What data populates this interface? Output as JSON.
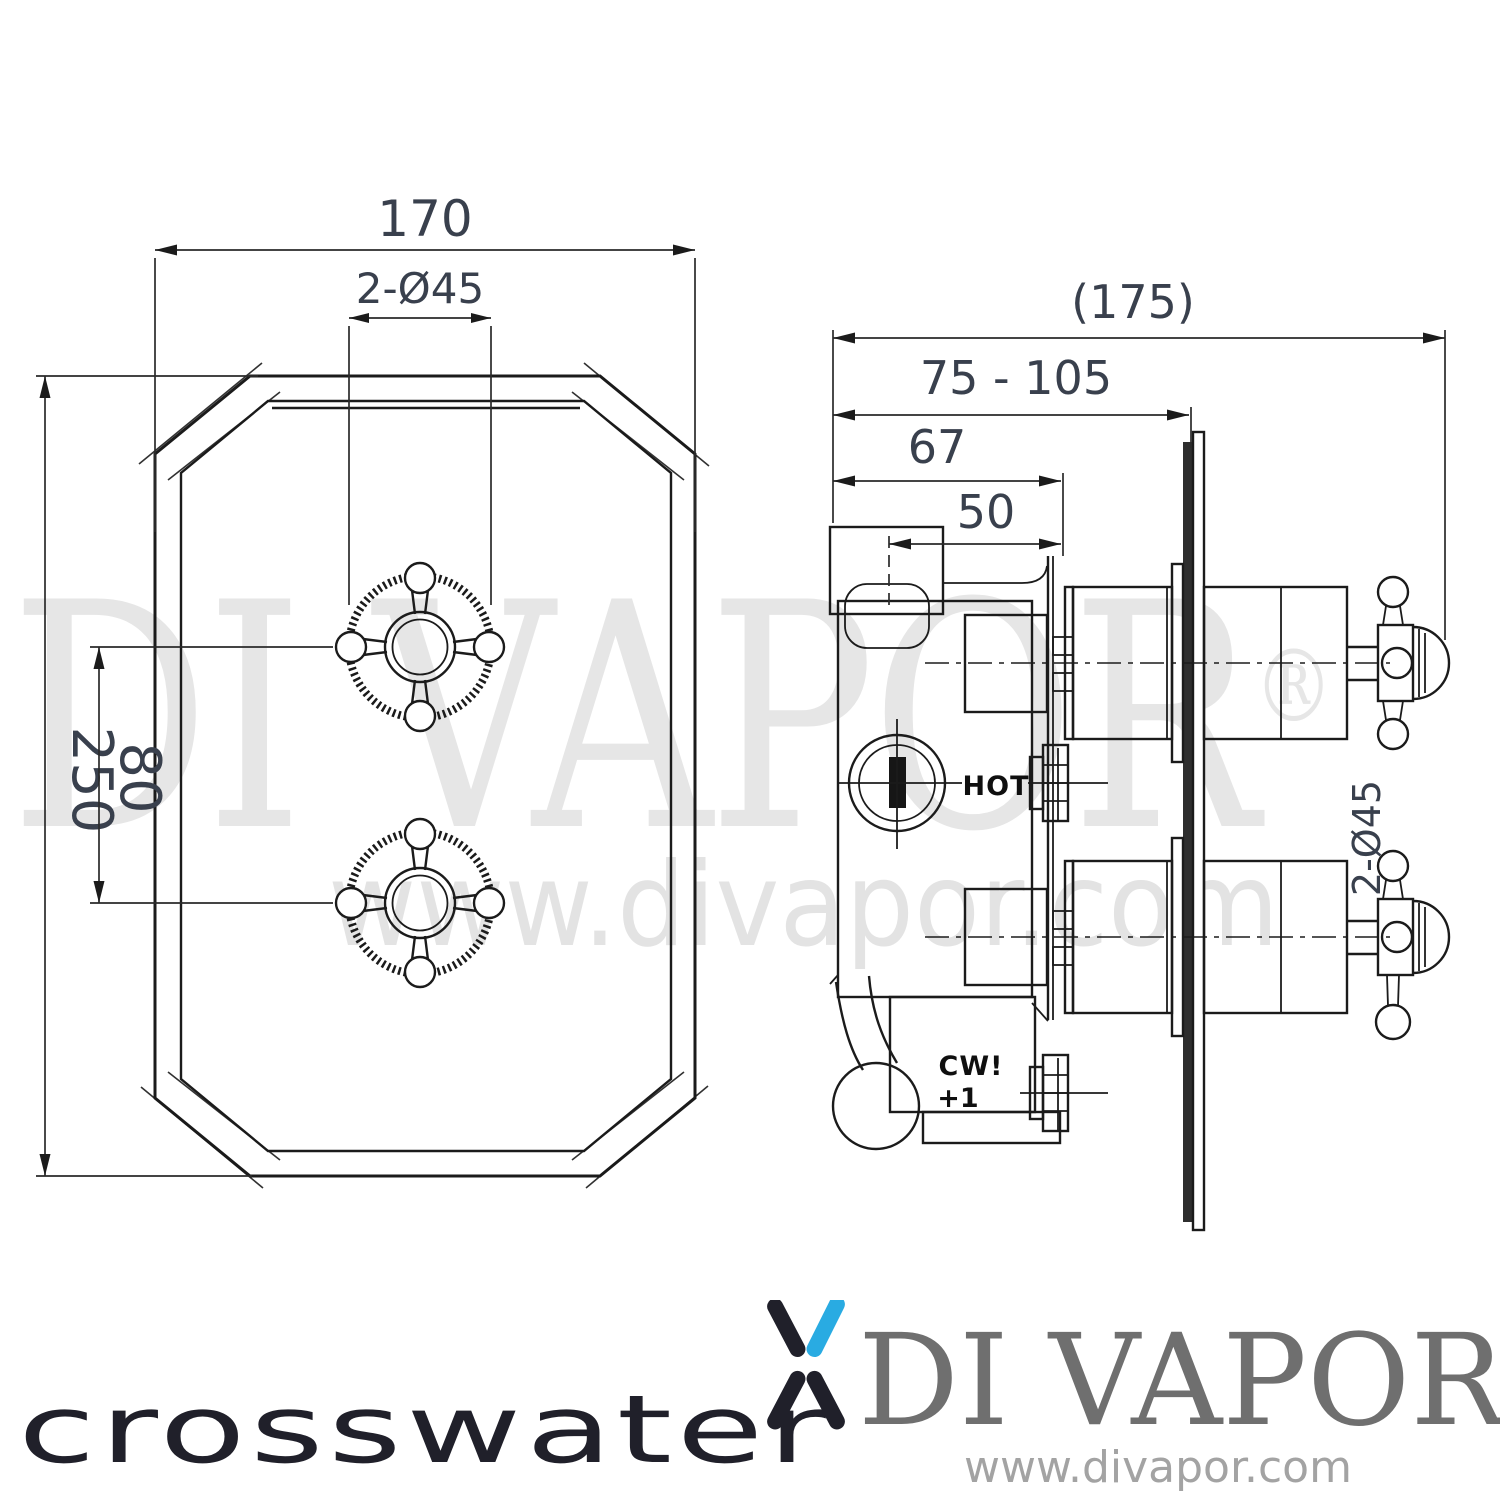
{
  "watermarks": {
    "brand": "DI VAPOR",
    "reg": "®",
    "site": "www.divapor.com"
  },
  "front_view": {
    "dim_width": "170",
    "dim_holes": "2-Ø45",
    "dim_height": "250",
    "dim_spacing": "80"
  },
  "side_view": {
    "dim_overall": "(175)",
    "dim_depth_range": "75 - 105",
    "dim_bracket": "67",
    "dim_port": "50",
    "dim_trim": "2-Ø45",
    "label_hot": "HOT",
    "label_cw": "CW!",
    "label_plus": "+1"
  },
  "footer": {
    "crosswater": "crosswater",
    "brand": "DI VAPOR",
    "brand_reg": "®",
    "site": "www.divapor.com"
  },
  "colors": {
    "accent": "#29abe2",
    "line": "#1b1b1b",
    "dim_text": "#39404d",
    "watermark": "#e5e5e5",
    "brand_gray": "#6f6f6f",
    "site_gray": "#a3a3a3",
    "logo_dark": "#20202a"
  }
}
